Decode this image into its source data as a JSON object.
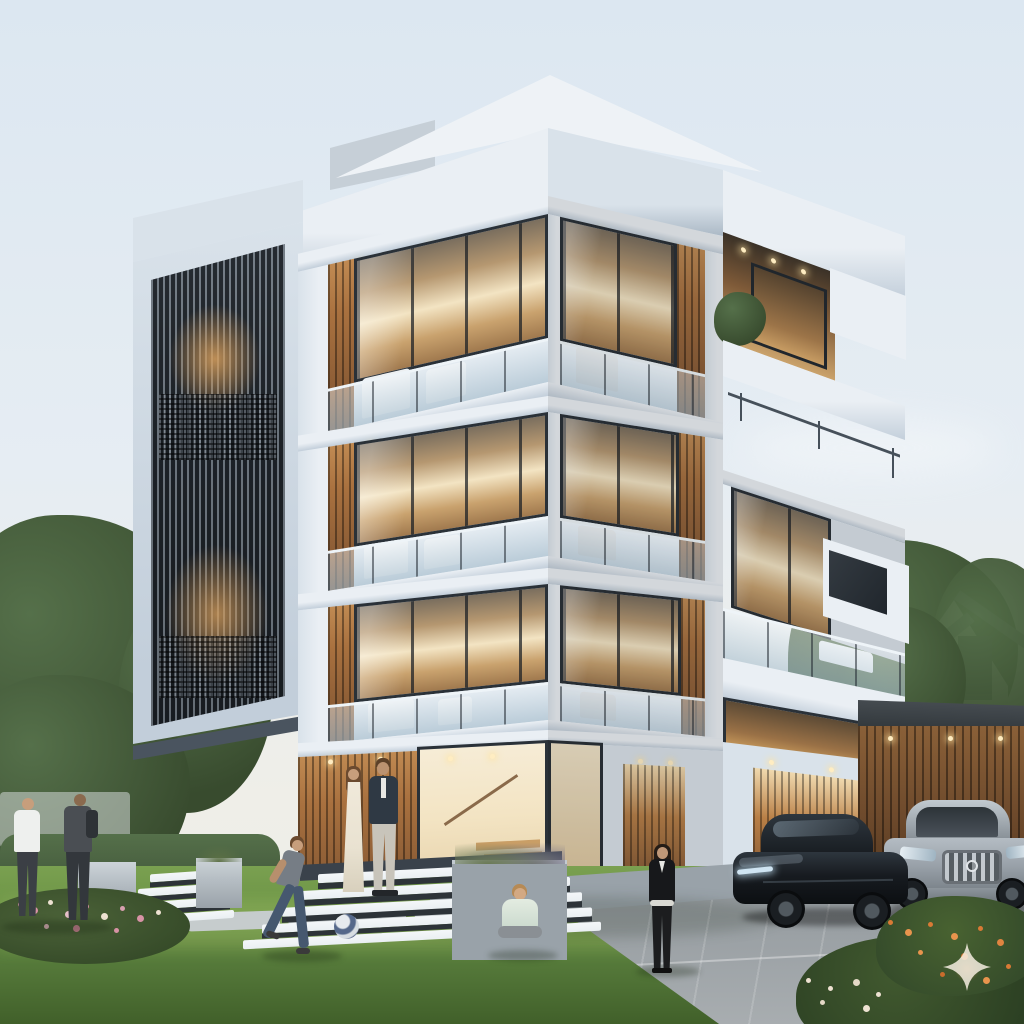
{
  "meta": {
    "type": "architectural-exterior-render",
    "dimensions": "1024x1024",
    "time_of_day": "dusk with warm interior lighting"
  },
  "palette": {
    "sky_top": "#dce7f1",
    "sky_mid": "#e6edf3",
    "sky_low": "#efeee8",
    "cloud": "#ffffff",
    "facade_lit": "#eaeff4",
    "facade_mid": "#d9e2ea",
    "facade_shade": "#c2ceda",
    "facade_deep": "#a8b6c3",
    "roof_white": "#eef2f6",
    "frame_dark": "#2a3138",
    "glazing_warm": "#c9a26e",
    "interior_glow": "#f3e4c3",
    "wood": "#a9713f",
    "wood_dark": "#7b5130",
    "tower_dark": "#30373e",
    "tower_line": "#98a3ad",
    "lawn": "#6a9345",
    "lawn_dark": "#41602a",
    "hedge": "#42573a",
    "tree": "#55704a",
    "tree_dark": "#384b2e",
    "drive": "#9aa0a4",
    "paver": "#c6cccd",
    "wall_gray": "#99a2a9",
    "planter": "#b7bfc5",
    "step_white": "#eaeff2",
    "riser_dark": "#2d3338",
    "house_wall": "#e9e7e2",
    "house_roof": "#828a91",
    "car_black": "#14181c",
    "car_black_hi": "#2e363e",
    "car_gray": "#9aa2aa",
    "car_gray_dark": "#7e868d",
    "chrome": "#c3c9ce",
    "skin": "#c79e7c",
    "hair_brown": "#6b4a2f",
    "dress_cream": "#e9e2d1",
    "blazer_navy": "#2f3944",
    "trouser_light": "#c8c4ba",
    "tee_gray": "#767d85",
    "jeans_blue": "#46586f",
    "outfit_black": "#17181b",
    "shirt_white": "#eef0ee",
    "ball_blue": "#55688a",
    "flower_pink": "#d893a6",
    "flower_cream": "#eee2d2",
    "flower_orange": "#d97a35",
    "glow": "#ffedc2",
    "watermark": "#f4ede0"
  },
  "scene": {
    "setting": "Modern four-storey white residential villa at dusk, warm lit interiors, family in front yard, two cars on driveway",
    "building": {
      "storeys": 4,
      "features": [
        "stacked white rectangular frame facades in two-point perspective",
        "corner balconies with frameless glass railings and white lounge furniture",
        "vertical wood slat accent walls",
        "tall dark metal louvre screen tower on the left",
        "cantilevered top roof slab with recessed downlights",
        "roof terrace with thin metal railing and balcony planter shrub",
        "floating white box volume on right facade",
        "glazed double-height entrance showing interior wooden staircase",
        "attached garage wing with wood slat doors and downlights"
      ]
    },
    "people": [
      {
        "id": "man-white-shirt",
        "description": "man in white t-shirt and dark trousers chatting, far left on lawn"
      },
      {
        "id": "man-grey-shirt",
        "description": "man in dark grey shirt with backpack facing him"
      },
      {
        "id": "woman-cream-dress",
        "description": "woman in long cream dress standing on entrance steps"
      },
      {
        "id": "man-navy-blazer",
        "description": "man in navy blazer and light trousers beside her"
      },
      {
        "id": "boy-running",
        "description": "boy in grey tee and blue jeans running after a football"
      },
      {
        "id": "toddler-sitting",
        "description": "toddler in pale shirt sitting on the lawn, seen from behind"
      },
      {
        "id": "woman-black-outfit",
        "description": "woman in black top, trousers and white belt walking on the driveway"
      }
    ],
    "vehicles": [
      {
        "id": "black-sedan",
        "description": "black luxury fastback sedan parked facing left",
        "color": "black"
      },
      {
        "id": "silver-crossover",
        "description": "silver-grey Mercedes-style crossover facing viewer with chrome grille",
        "color": "silver-grey"
      }
    ],
    "landscape": [
      "manicured green lawn",
      "white cascading entrance steps with dark risers",
      "grey concrete planter cubes",
      "light stone paver path across grass",
      "pink flower bed lower left",
      "orange flowering shrub lower right",
      "clipped hedge on left",
      "mature leafy trees left and right",
      "paved driveway with joint lines"
    ],
    "background": {
      "house": "neighbouring white house with grey gable roof among trees",
      "sky": "pale hazy dusk sky with soft clouds"
    },
    "objects": [
      {
        "id": "football",
        "description": "blue-grey and white football on the lawn"
      }
    ],
    "watermark": {
      "shape": "four-pointed sparkle",
      "position": "lower right",
      "style": "translucent cream with faint orange core"
    }
  }
}
